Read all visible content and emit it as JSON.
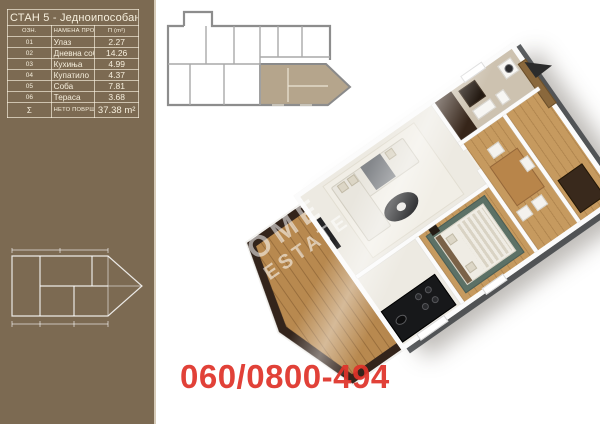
{
  "sidebar": {
    "table": {
      "title": "СТАН 5 - Једноипособан",
      "col_id": "ОЗН.",
      "col_name": "НАМЕНА ПРОСТОРИЈЕ",
      "col_area": "П (m²)",
      "rows": [
        {
          "id": "01",
          "name": "Улаз",
          "area": "2.27"
        },
        {
          "id": "02",
          "name": "Дневна соба са обед.",
          "area": "14.26"
        },
        {
          "id": "03",
          "name": "Кухиња",
          "area": "4.99"
        },
        {
          "id": "04",
          "name": "Купатило",
          "area": "4.37"
        },
        {
          "id": "05",
          "name": "Соба",
          "area": "7.81"
        },
        {
          "id": "06",
          "name": "Тераса",
          "area": "3.68"
        }
      ],
      "sum_symbol": "Σ",
      "sum_label": "НЕТО ПОВРШИНА СТАНА",
      "sum_area": "37.38 m²"
    }
  },
  "main": {
    "phone": "060/0800-494",
    "watermark_line1": "OME",
    "watermark_line2": "ESTATE"
  },
  "colors": {
    "sidebar_bg": "#7c6a52",
    "key_plan_unit_highlight": "#b5a58c",
    "key_plan_walls": "#8d8d8d",
    "phone_red": "#df332a",
    "wood_floor": "#c69a5f",
    "terrace_parapet": "#33241b",
    "bath_dark_wall": "#362519",
    "bedroom_rug": "#5c7166"
  }
}
